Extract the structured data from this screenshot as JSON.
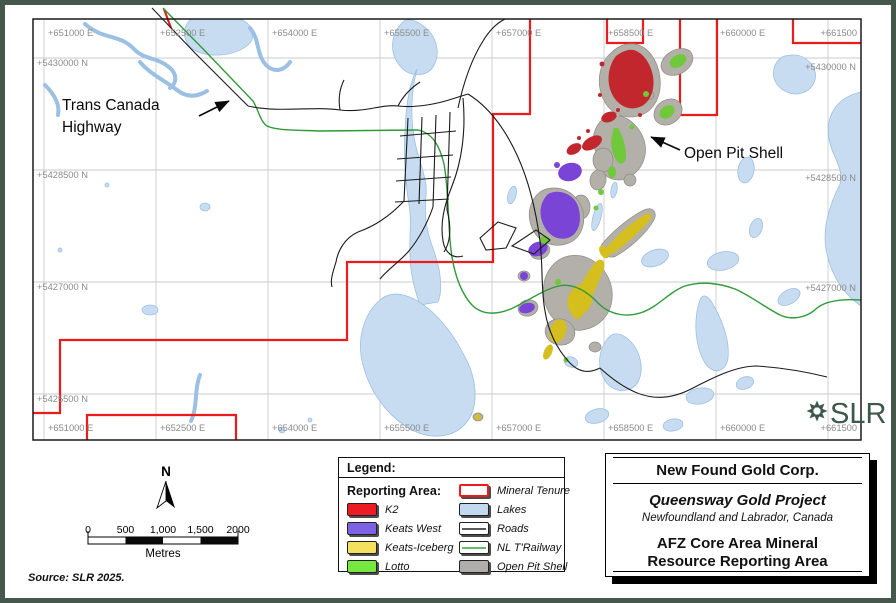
{
  "map": {
    "grid_labels": {
      "top": [
        "+651000 E",
        "+652500 E",
        "+654000 E",
        "+655500 E",
        "+657000 E",
        "+658500 E",
        "+660000 E",
        "+661500"
      ],
      "bottom": [
        "+651000 E",
        "+652500 E",
        "+654000 E",
        "+655500 E",
        "+657000 E",
        "+658500 E",
        "+660000 E",
        "+661500"
      ],
      "left": [
        "+5430000 N",
        "+5428500 N",
        "+5427000 N",
        "+5425500 N"
      ],
      "right": [
        "+5430000 N",
        "+5428500 N",
        "+5427000 N"
      ]
    },
    "annotations": {
      "highway_line1": "Trans Canada",
      "highway_line2": "Highway",
      "open_pit": "Open Pit Shell"
    },
    "logo_text": "SLR"
  },
  "north_arrow": {
    "label": "N"
  },
  "scale_bar": {
    "ticks": [
      "0",
      "500",
      "1,000",
      "1,500",
      "2000"
    ],
    "unit": "Metres"
  },
  "legend": {
    "title": "Legend:",
    "reporting_area_heading": "Reporting Area:",
    "reporting_items": [
      {
        "label": "K2",
        "color": "#ed1c24"
      },
      {
        "label": "Keats West",
        "color": "#7d62e6"
      },
      {
        "label": "Keats-Iceberg",
        "color": "#f5e15e"
      },
      {
        "label": "Lotto",
        "color": "#77e83f"
      }
    ],
    "map_items": [
      {
        "label": "Mineral Tenure",
        "swatch": "outline",
        "color": "#ed1c1c"
      },
      {
        "label": "Lakes",
        "swatch": "fill",
        "color": "#c3d9f0"
      },
      {
        "label": "Roads",
        "swatch": "line",
        "color": "#5a5a5a"
      },
      {
        "label": "NL T'Railway",
        "swatch": "line",
        "color": "#66bf66"
      },
      {
        "label": "Open Pit Shell",
        "swatch": "fill",
        "color": "#b0adad"
      }
    ]
  },
  "title_block": {
    "company": "New Found Gold Corp.",
    "project": "Queensway Gold Project",
    "location": "Newfoundland and Labrador, Canada",
    "title_line1": "AFZ Core Area Mineral",
    "title_line2": "Resource Reporting Area"
  },
  "source_note": "Source: SLR 2025.",
  "colors": {
    "tenure": "#ec1c1c",
    "lakes_fill": "#c7dcf1",
    "roads": "#1b1b1b",
    "railway": "#2e9b38",
    "shell": "#b3afa9",
    "k2": "#c1272d",
    "keats_west": "#7a45d6",
    "keats_iceberg": "#d4bf1e",
    "lotto": "#6fc93a",
    "slr_logo": "#3d584b"
  }
}
